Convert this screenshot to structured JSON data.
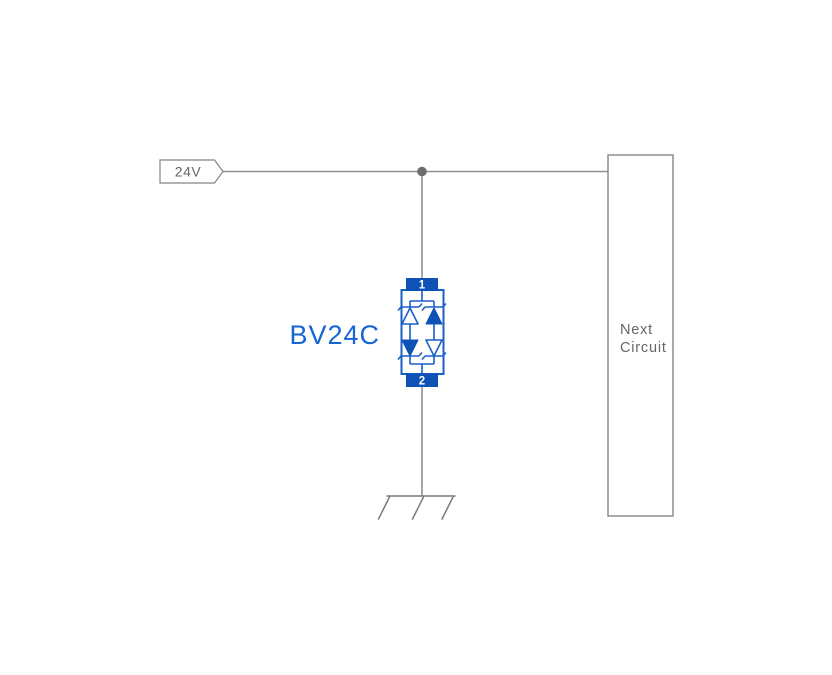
{
  "diagram": {
    "supply_flag": {
      "label": "24V"
    },
    "component": {
      "label": "BV24C",
      "pin_top": "1",
      "pin_bottom": "2"
    },
    "next_circuit_box": {
      "line1": "Next",
      "line2": "Circuit"
    },
    "colors": {
      "wire_gray": "#8f8f8f",
      "outline_gray": "#858585",
      "text_gray": "#666666",
      "component_blue": "#0d52b4",
      "stroke_blue": "#1a5fc8",
      "label_blue": "#1565d2",
      "pin_text_white": "#ffffff",
      "background": "#ffffff"
    }
  }
}
